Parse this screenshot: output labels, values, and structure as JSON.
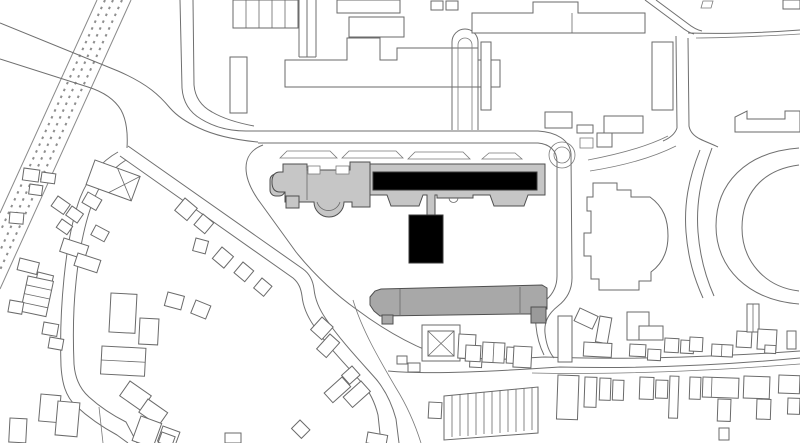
{
  "map": {
    "kind": "architectural figure-ground site plan",
    "background": "#ffffff",
    "line_color": "#6f6f6f",
    "fills": {
      "highlight_black": "#000000",
      "complex_light_gray": "#c6c6c6",
      "secondary_gray": "#a8a8a8",
      "annex_gray": "#9a9a9a",
      "ground_white": "#ffffff"
    },
    "features": {
      "railway": "railway-corridor",
      "highlight": "highlighted-building-black",
      "palace": "main-building-complex-gray",
      "secondary": "secondary-gray-building",
      "oval": "oval-field",
      "church": "cross-roof-building",
      "housing": "small-house-outlines",
      "roads": "street-network"
    }
  }
}
